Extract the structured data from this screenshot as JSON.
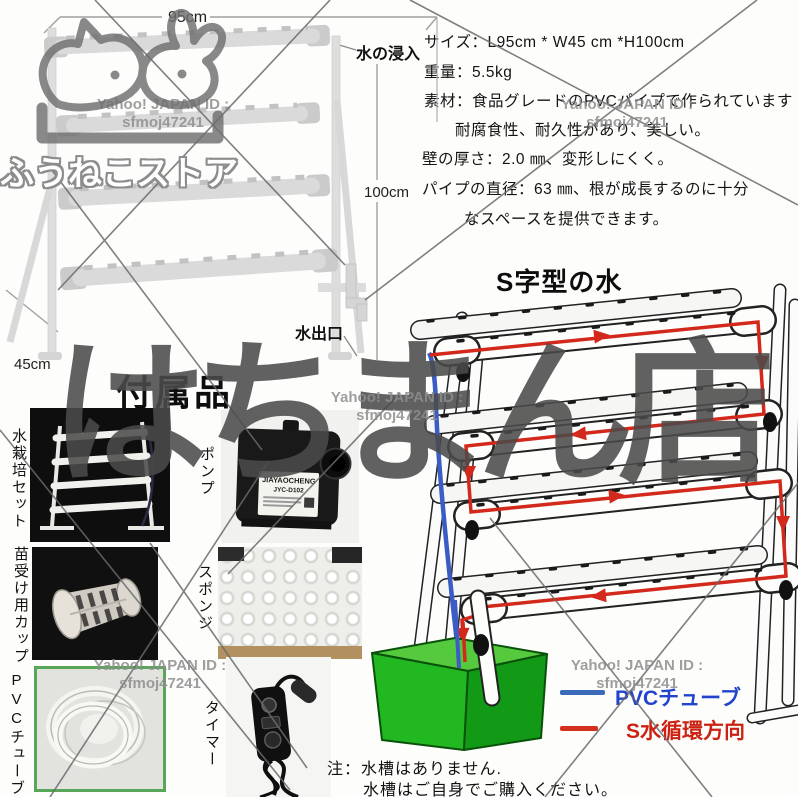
{
  "watermarks": {
    "store_name": "ふうねこストア",
    "shop_stamp": "はちまん店",
    "yahoo_id_line1": "Yahoo! JAPAN ID :",
    "yahoo_id_line2": "sfmoj47241"
  },
  "dimension_diagram": {
    "width_label": "95cm",
    "height_label": "100cm",
    "depth_label": "45cm",
    "water_inlet_label": "水の浸入",
    "water_outlet_label": "水出口"
  },
  "specs": {
    "lines": [
      "サイズ：L95cm * W45 cm *H100cm",
      "重量：5.5kg",
      "素材：食品グレードのPVCパイプで作られています",
      "耐腐食性、耐久性があり、美しい。",
      "壁の厚さ：2.0 ㎜、変形しにくく。",
      "パイプの直径：63 ㎜、根が成長するのに十分",
      "なスペースを提供できます。"
    ]
  },
  "s_diagram": {
    "title": "S字型の水"
  },
  "accessories": {
    "heading": "付属品",
    "items": [
      {
        "label": "水栽培セット"
      },
      {
        "label": "苗受け用カップ"
      },
      {
        "label": "PVCチューブ"
      },
      {
        "label": "ポンプ"
      },
      {
        "label": "スポンジ"
      },
      {
        "label": "タイマー"
      }
    ],
    "pump_brand": "JIAYAOCHENG",
    "pump_model": "JYC-D102"
  },
  "legend": {
    "items": [
      {
        "label": "PVCチューブ",
        "color": "#2b4fc0"
      },
      {
        "label": "S水循環方向",
        "color": "#d02415"
      }
    ]
  },
  "note": {
    "line1": "注：水槽はありません.",
    "line2": "水槽はご自身でご購入ください。"
  },
  "colors": {
    "flow_red": "#d3281c",
    "tube_blue": "#3c5cc5",
    "tank_green": "#22b822",
    "watermark_gray": "#8e8e8e"
  }
}
